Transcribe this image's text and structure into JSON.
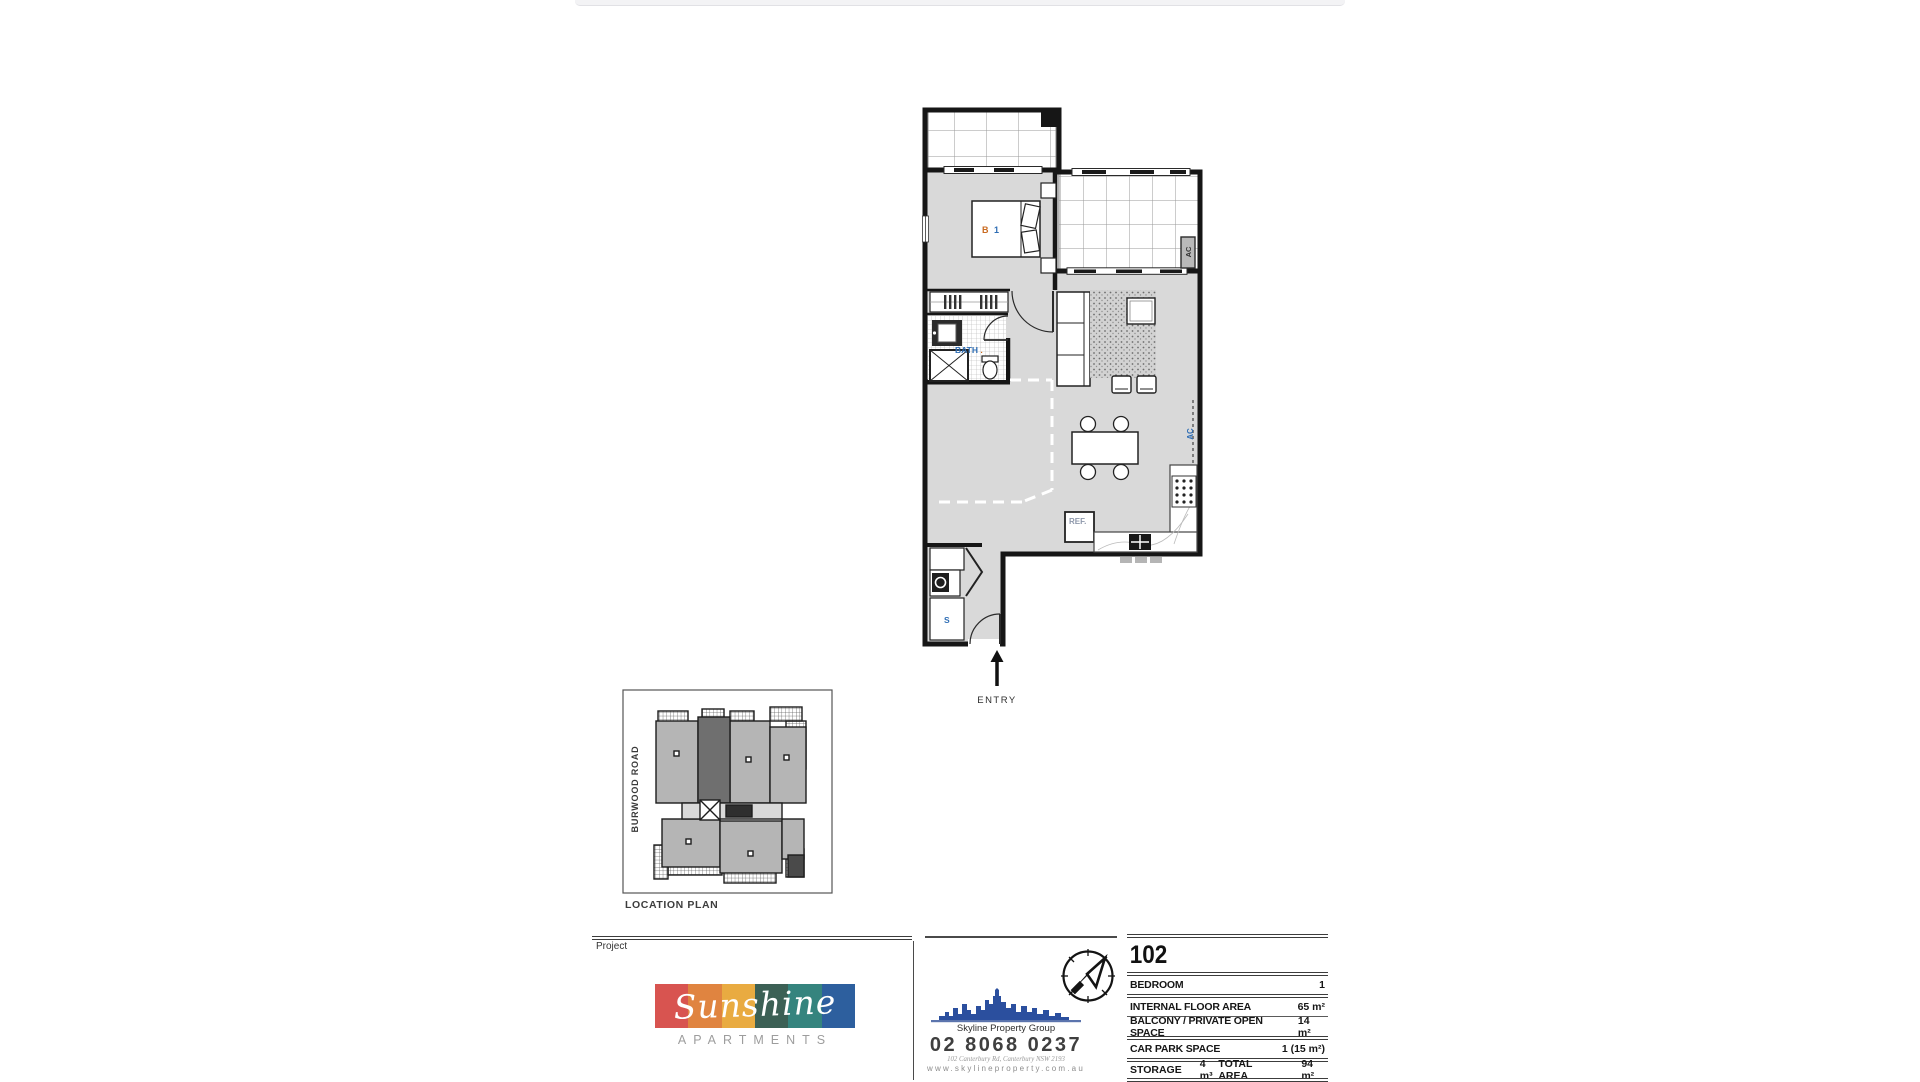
{
  "floor_plan": {
    "bed_label_b": "B",
    "bed_label_1": "1",
    "bath_label": "BATH",
    "bath_label_dot": ".",
    "ac_balcony_label": "AC",
    "ac_wall_label": "AC",
    "ref_label": "REF.",
    "storage_label": "S",
    "entry_label": "ENTRY"
  },
  "location_plan": {
    "road_label": "BURWOOD ROAD",
    "caption": "LOCATION PLAN"
  },
  "title_block": {
    "project_label": "Project",
    "project_name": "Sunshine",
    "project_subtitle": "APARTMENTS",
    "logo_block_colors": [
      "#d85450",
      "#e08440",
      "#e9ab41",
      "#3c6055",
      "#35847e",
      "#2d5f9e"
    ],
    "agency_name": "Skyline Property Group",
    "agency_phone": "02 8068 0237",
    "agency_address": "102 Canterbury Rd, Canterbury NSW 2193",
    "agency_website": "www.skylineproperty.com.au",
    "unit": {
      "number": "102",
      "rows": [
        {
          "label": "BEDROOM",
          "value": "1"
        },
        {
          "label": "INTERNAL FLOOR AREA",
          "value": "65 m²"
        },
        {
          "label": "BALCONY / PRIVATE OPEN SPACE",
          "value": "14 m²"
        },
        {
          "label": "CAR PARK SPACE",
          "value": "1 (15 m²)"
        }
      ],
      "storage_label": "STORAGE",
      "storage_value": "4 m³",
      "total_label": "TOTAL AREA",
      "total_value": "94 m²"
    },
    "accent_colors": {
      "label_blue": "#2e6db4",
      "label_orange": "#c96a1f",
      "skyline_blue": "#2b4f9e"
    }
  }
}
